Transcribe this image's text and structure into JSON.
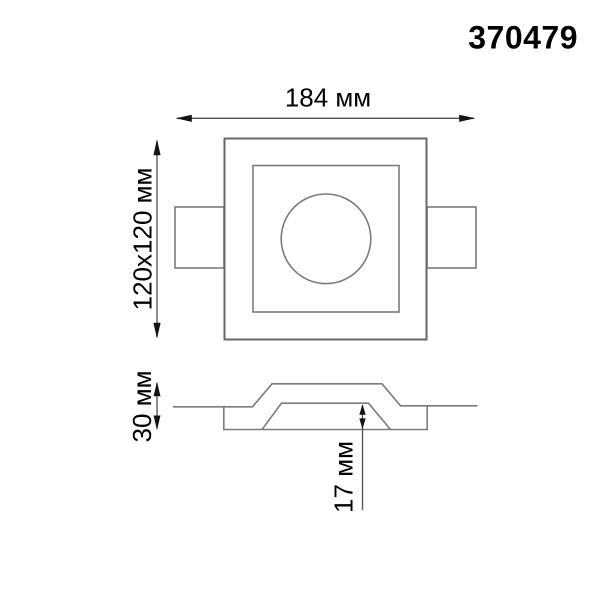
{
  "product": {
    "number": "370479"
  },
  "drawing": {
    "kind": "technical-dimension-drawing",
    "views": [
      "top-view",
      "section-view"
    ],
    "units": "мм",
    "dimensions": {
      "overall_width": {
        "label": "184 мм",
        "value": 184
      },
      "face_size": {
        "label": "120x120 мм",
        "value_w": 120,
        "value_h": 120
      },
      "body_depth": {
        "label": "30 мм",
        "value": 30
      },
      "recess_depth": {
        "label": "17 мм",
        "value": 17
      }
    },
    "colors": {
      "background": "#ffffff",
      "outline": "#7b7b7b",
      "outline_heavy": "#676767",
      "dimension_line": "#4f4f4f",
      "arrow": "#141414",
      "text": "#000000"
    }
  }
}
